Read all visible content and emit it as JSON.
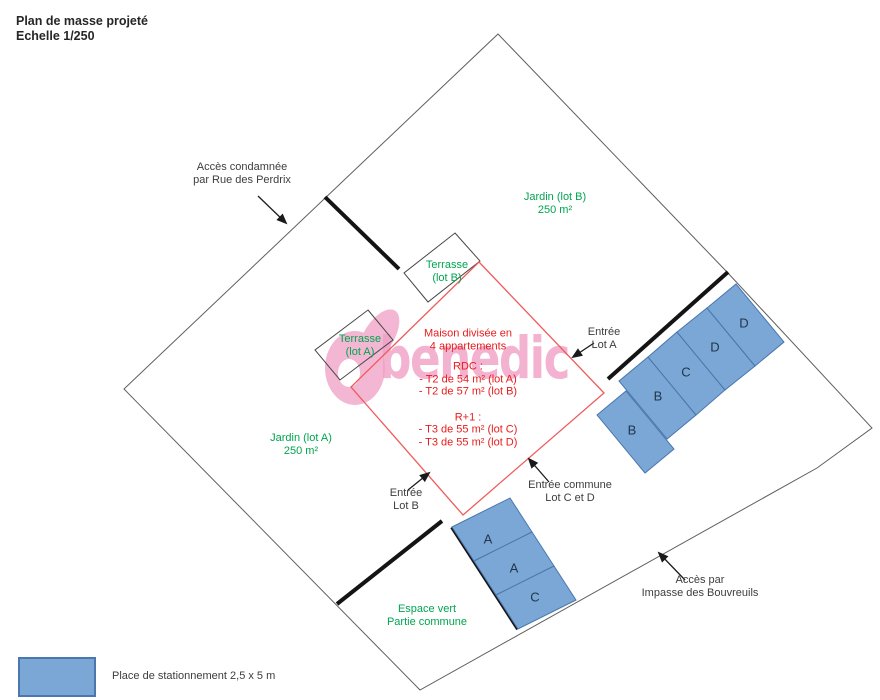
{
  "title": {
    "line1": "Plan de masse projeté",
    "line2": "Echelle 1/250"
  },
  "watermark": {
    "text": "benedic"
  },
  "areas": {
    "jardin_b": {
      "line1": "Jardin (lot B)",
      "line2": "250 m²"
    },
    "jardin_a": {
      "line1": "Jardin (lot A)",
      "line2": "250 m²"
    },
    "terrasse_b": {
      "line1": "Terrasse",
      "line2": "(lot B)"
    },
    "terrasse_a": {
      "line1": "Terrasse",
      "line2": "(lot A)"
    },
    "espace_vert": {
      "line1": "Espace vert",
      "line2": "Partie commune"
    }
  },
  "house": {
    "title1": "Maison divisée en",
    "title2": "4 appartements",
    "rdc_header": "RDC :",
    "rdc_line1": "- T2 de 54 m²  (lot A)",
    "rdc_line2": "- T2 de 57 m² (lot B)",
    "r1_header": "R+1 :",
    "r1_line1": "- T3 de 55 m² (lot C)",
    "r1_line2": "- T3 de 55 m² (lot D)"
  },
  "annotations": {
    "acces_condamnee": {
      "line1": "Accès condamnée",
      "line2": "par Rue des Perdrix"
    },
    "entree_lot_a": {
      "line1": "Entrée",
      "line2": "Lot A"
    },
    "entree_lot_b": {
      "line1": "Entrée",
      "line2": "Lot B"
    },
    "entree_commune": {
      "line1": "Entrée commune",
      "line2": "Lot C et D"
    },
    "acces_impasse": {
      "line1": "Accès par",
      "line2": "Impasse des Bouvreuils"
    }
  },
  "parking": {
    "right": [
      "B",
      "B",
      "C",
      "D",
      "D"
    ],
    "bottom": [
      "A",
      "A",
      "C"
    ]
  },
  "legend": {
    "label": "Place de stationnement 2,5 x 5 m"
  },
  "colors": {
    "parking_fill": "#7aa7d6",
    "parking_border": "#4a77ad",
    "green_text": "#00a550",
    "red_line": "#f05a5a",
    "red_text": "#e81c1c",
    "watermark_pink": "#efa0c5"
  }
}
